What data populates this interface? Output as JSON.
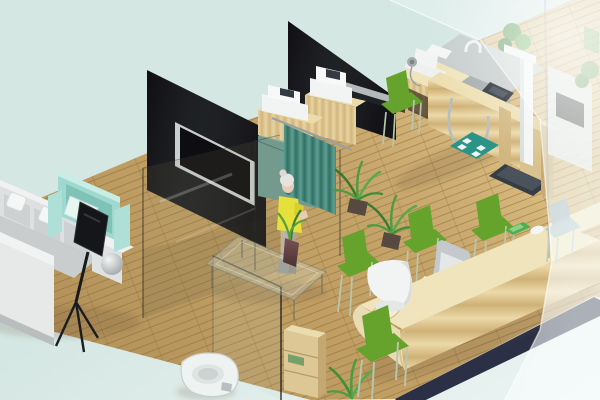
{
  "image": {
    "type": "isometric-3d-interior-render",
    "description": "Isometric 3D rendering of a small clinic interior: waiting lounge with gray L-sofa and mint armchair, dark glass partition walls with wall TV, teal privacy curtain with standing woman in a yellow dress, printer stands, medical examination station with height-weight scale, toilet behind a clear glass screen, long pine reception counter with green visitor chairs, and a frosted glass wall on the right.",
    "visible_text": ""
  },
  "palette": {
    "background": "#d5e7e3",
    "background_light": "#eef7f4",
    "floor_wood": "#c9a76b",
    "floor_edge_dark": "#2b3046",
    "partition_glass_dark": "#0a0a0e",
    "curtain_teal": "#3c8a7b",
    "locker_teal": "#6f9c92",
    "armchair_mint": "#9fd8cf",
    "sofa_gray": "#dddfe0",
    "chair_green": "#65a32c",
    "desk_pine": "#f0e4bc",
    "counter_gray": "#c6cdcc",
    "device_white": "#f2f4f4",
    "screen_dark": "#23282f",
    "mat_teal": "#2c9486",
    "plant_green": "#4f9b40",
    "scale_platform": "#363c44",
    "dress_yellow": "#e6e03a",
    "skin": "#e8cdb5",
    "hair_gray": "#e7e4df",
    "toilet_white": "#eef2f1",
    "shelf_wood": "#dcc795"
  },
  "objects": [
    {
      "name": "wood-plank-floor",
      "area": "whole-room"
    },
    {
      "name": "dark-glass-partition-left",
      "area": "center-left"
    },
    {
      "name": "wall-mounted-tv",
      "area": "center-left"
    },
    {
      "name": "dark-glass-partition-center",
      "area": "top-center"
    },
    {
      "name": "teal-privacy-curtain",
      "area": "center"
    },
    {
      "name": "standing-woman-yellow-dress",
      "area": "center"
    },
    {
      "name": "printer-stand",
      "area": "center",
      "count": 2
    },
    {
      "name": "teal-cabinet",
      "area": "center-left"
    },
    {
      "name": "potted-plant",
      "area": "center-floor",
      "count": 2
    },
    {
      "name": "gray-sink-counter-with-faucet",
      "area": "top-right"
    },
    {
      "name": "exam-desk-with-monitor-device",
      "area": "top-right"
    },
    {
      "name": "equipment-counter-with-tablet-and-hose",
      "area": "top-right"
    },
    {
      "name": "teal-foot-mat",
      "area": "top-right"
    },
    {
      "name": "height-weight-scale",
      "area": "top-right"
    },
    {
      "name": "green-side-chair-exam",
      "area": "top-right"
    },
    {
      "name": "l-shaped-gray-sofa",
      "area": "waiting-left"
    },
    {
      "name": "mint-armchair-with-pillow",
      "area": "waiting-left"
    },
    {
      "name": "tv-on-easel-stand",
      "area": "waiting-left"
    },
    {
      "name": "sphere-lamp",
      "area": "waiting-left"
    },
    {
      "name": "glass-coffee-table-with-plant-vase",
      "area": "waiting-center"
    },
    {
      "name": "toilet",
      "area": "bottom-center"
    },
    {
      "name": "glass-toilet-screen",
      "area": "bottom-center"
    },
    {
      "name": "wooden-shelf-unit",
      "area": "bottom-center"
    },
    {
      "name": "floor-plant",
      "area": "bottom-center"
    },
    {
      "name": "reception-counter",
      "area": "bottom-right"
    },
    {
      "name": "white-monitor",
      "area": "reception"
    },
    {
      "name": "white-office-chair",
      "area": "reception"
    },
    {
      "name": "green-phone-tray",
      "area": "reception"
    },
    {
      "name": "computer-mouse",
      "area": "reception"
    },
    {
      "name": "green-visitor-chair",
      "area": "reception",
      "count": 4
    },
    {
      "name": "frosted-glass-wall",
      "area": "right"
    },
    {
      "name": "check-in-kiosk-hazy",
      "area": "behind-frosted-glass"
    },
    {
      "name": "chair-hazy",
      "area": "behind-frosted-glass"
    },
    {
      "name": "plant-hazy",
      "area": "behind-frosted-glass"
    }
  ]
}
